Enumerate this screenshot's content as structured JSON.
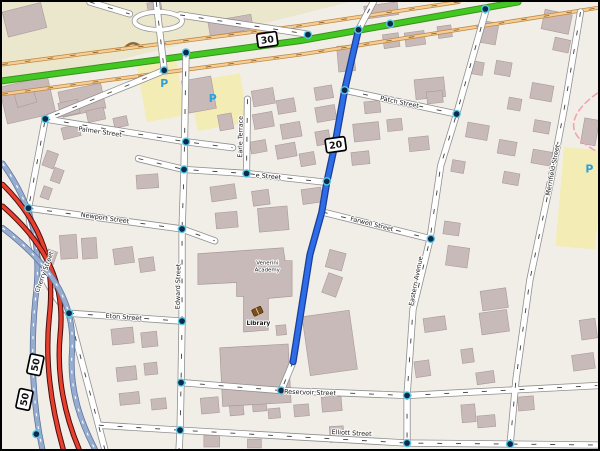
{
  "app": {
    "title": "Map view with highlighted route"
  },
  "colors": {
    "land": "#f1eee8",
    "khaki": "#ebe7cc",
    "parking_fill": "#f3ecb4",
    "building": "#c9baba",
    "building_border": "#a99a9a",
    "street_fill": "#ffffff",
    "street_casing": "#8f8f8f",
    "street_dash": "#3d3d3d",
    "green_road": "#41c922",
    "green_casing": "#3d8f1d",
    "tan_fill": "#f2cf9a",
    "tan_casing": "#c8873a",
    "motorway_fill": "#97adcf",
    "motorway_casing": "#5f74a0",
    "trunk_red": "#e8402e",
    "trunk_casing": "#4a0d0d",
    "route_blue": "#2e6ce8",
    "route_casing": "#173f9b",
    "dot_ring": "#57c8e6",
    "dot_core": "#0c2b4a",
    "boundary_pink": "#f2a3ad",
    "parking_icon": "#2d9fdb",
    "school_label": "#50507c",
    "library_label": "#6b5a10",
    "book_icon": "#7c4f17"
  },
  "map": {
    "width": 600,
    "height": 451,
    "khaki_poly": "0,0 350,0 0,88",
    "parking_areas": [
      [
        140,
        60,
        40,
        58,
        -10
      ],
      [
        192,
        76,
        52,
        50,
        -10
      ],
      [
        562,
        148,
        40,
        100,
        5
      ]
    ],
    "hedge_arc": "M122,48 Q130,37 139,45",
    "buildings": [
      [
        2,
        5,
        40,
        26,
        -14
      ],
      [
        0,
        80,
        50,
        38,
        -13
      ],
      [
        58,
        86,
        44,
        26,
        -12
      ],
      [
        208,
        16,
        44,
        15,
        -10
      ],
      [
        146,
        0,
        14,
        8,
        -10
      ],
      [
        365,
        2,
        34,
        13,
        -8
      ],
      [
        545,
        10,
        28,
        20,
        12
      ],
      [
        556,
        37,
        16,
        13,
        12
      ],
      [
        13,
        90,
        20,
        14,
        -16
      ],
      [
        57,
        100,
        20,
        14,
        -12
      ],
      [
        85,
        108,
        18,
        12,
        -12
      ],
      [
        112,
        116,
        14,
        10,
        -12
      ],
      [
        183,
        77,
        30,
        33,
        -10
      ],
      [
        40,
        153,
        16,
        12,
        -70
      ],
      [
        48,
        170,
        14,
        10,
        -70
      ],
      [
        38,
        188,
        12,
        9,
        -70
      ],
      [
        135,
        174,
        22,
        14,
        -4
      ],
      [
        60,
        125,
        18,
        12,
        -14
      ],
      [
        58,
        235,
        17,
        24,
        -4
      ],
      [
        80,
        238,
        15,
        21,
        -4
      ],
      [
        112,
        248,
        20,
        16,
        -8
      ],
      [
        138,
        258,
        15,
        14,
        -8
      ],
      [
        42,
        252,
        13,
        10,
        -70
      ],
      [
        110,
        329,
        22,
        16,
        -6
      ],
      [
        140,
        333,
        16,
        15,
        -6
      ],
      [
        115,
        368,
        20,
        14,
        -6
      ],
      [
        143,
        364,
        13,
        12,
        -6
      ],
      [
        118,
        394,
        20,
        12,
        -6
      ],
      [
        150,
        400,
        15,
        11,
        -6
      ],
      [
        218,
        113,
        14,
        16,
        -10
      ],
      [
        252,
        88,
        22,
        16,
        -10
      ],
      [
        277,
        98,
        18,
        14,
        -10
      ],
      [
        315,
        85,
        18,
        13,
        -10
      ],
      [
        316,
        105,
        20,
        15,
        -10
      ],
      [
        253,
        112,
        20,
        15,
        -10
      ],
      [
        281,
        122,
        20,
        15,
        -10
      ],
      [
        316,
        130,
        14,
        14,
        -10
      ],
      [
        276,
        143,
        20,
        14,
        -10
      ],
      [
        250,
        140,
        16,
        12,
        -10
      ],
      [
        300,
        152,
        15,
        13,
        -10
      ],
      [
        210,
        185,
        25,
        15,
        -8
      ],
      [
        252,
        190,
        17,
        15,
        -8
      ],
      [
        302,
        188,
        20,
        15,
        -8
      ],
      [
        258,
        207,
        30,
        24,
        -5
      ],
      [
        215,
        212,
        22,
        16,
        -5
      ],
      [
        338,
        44,
        17,
        26,
        -5
      ],
      [
        384,
        32,
        16,
        14,
        -8
      ],
      [
        406,
        30,
        20,
        14,
        -8
      ],
      [
        439,
        24,
        14,
        12,
        -8
      ],
      [
        416,
        77,
        30,
        20,
        -6
      ],
      [
        365,
        100,
        16,
        12,
        -6
      ],
      [
        354,
        122,
        26,
        18,
        -6
      ],
      [
        388,
        118,
        15,
        12,
        -6
      ],
      [
        410,
        136,
        20,
        14,
        -6
      ],
      [
        352,
        151,
        18,
        13,
        -6
      ],
      [
        428,
        90,
        16,
        12,
        -6
      ],
      [
        327,
        252,
        18,
        17,
        -75
      ],
      [
        322,
        278,
        21,
        15,
        -70
      ],
      [
        306,
        314,
        48,
        60,
        -8
      ],
      [
        482,
        20,
        17,
        22,
        10
      ],
      [
        470,
        60,
        15,
        13,
        10
      ],
      [
        497,
        60,
        16,
        14,
        10
      ],
      [
        533,
        83,
        22,
        16,
        10
      ],
      [
        510,
        97,
        13,
        12,
        10
      ],
      [
        536,
        120,
        16,
        12,
        10
      ],
      [
        500,
        140,
        18,
        14,
        10
      ],
      [
        534,
        150,
        20,
        14,
        10
      ],
      [
        505,
        172,
        16,
        12,
        10
      ],
      [
        468,
        123,
        22,
        15,
        10
      ],
      [
        453,
        160,
        13,
        12,
        10
      ],
      [
        448,
        247,
        22,
        20,
        8
      ],
      [
        445,
        222,
        16,
        13,
        8
      ],
      [
        483,
        290,
        26,
        20,
        -8
      ],
      [
        482,
        312,
        28,
        22,
        -8
      ],
      [
        463,
        350,
        12,
        14,
        -8
      ],
      [
        478,
        373,
        18,
        12,
        -8
      ],
      [
        425,
        318,
        22,
        14,
        -8
      ],
      [
        416,
        362,
        15,
        16,
        -8
      ],
      [
        200,
        399,
        18,
        16,
        -5
      ],
      [
        229,
        403,
        14,
        14,
        -5
      ],
      [
        252,
        398,
        14,
        15,
        -5
      ],
      [
        268,
        410,
        12,
        10,
        -5
      ],
      [
        294,
        406,
        15,
        12,
        -5
      ],
      [
        322,
        398,
        20,
        15,
        -5
      ],
      [
        463,
        406,
        14,
        18,
        -5
      ],
      [
        479,
        417,
        18,
        12,
        -5
      ],
      [
        520,
        398,
        16,
        14,
        -5
      ],
      [
        585,
        118,
        15,
        26,
        10
      ],
      [
        583,
        320,
        16,
        20,
        -8
      ],
      [
        575,
        355,
        22,
        16,
        -8
      ],
      [
        203,
        437,
        16,
        12,
        0
      ],
      [
        247,
        441,
        14,
        9,
        0
      ],
      [
        330,
        428,
        14,
        16,
        -3
      ],
      [
        276,
        326,
        10,
        10,
        -5
      ]
    ],
    "academy_polys": [
      "197,254 283,248 285,261 292,261 292,297 268,299 268,331 243,333 243,297 236,297 236,283 197,285",
      "219,349 288,345 291,404 222,408"
    ],
    "tan_roads": [
      "M0,63 L300,24 L460,0",
      "M0,93 L300,53 L600,6"
    ],
    "green_road": "M-4,80 L300,39 L520,0",
    "loop_ellipse": [
      157,
      19,
      24,
      9
    ],
    "streets": [
      {
        "name": "top-vertical-street",
        "d": "M155,0 L163,69"
      },
      {
        "name": "cherry-street-diagonal",
        "d": "M163,69 L43,118 L26,208 C30,260 45,290 67,314 L103,451"
      },
      {
        "name": "edward-street",
        "d": "M185,51 L183,169 L181,229 L181,322 L180,384 L179,432 L178,451"
      },
      {
        "name": "earle-terrace",
        "d": "M247,98 L246,172"
      },
      {
        "name": "e-street",
        "d": "M137,158 L183,169 L246,173 L327,182"
      },
      {
        "name": "palmer-street",
        "d": "M43,118 L185,141 L232,147"
      },
      {
        "name": "newport-street",
        "d": "M26,208 L181,229 L214,241"
      },
      {
        "name": "eton-street",
        "d": "M67,314 L181,322"
      },
      {
        "name": "reservoir-street",
        "d": "M180,384 L281,392 L408,397 L600,387"
      },
      {
        "name": "elliott-street",
        "d": "M97,427 L179,432 L408,445 L512,446 L600,447"
      },
      {
        "name": "patch-street",
        "d": "M345,89 L458,113"
      },
      {
        "name": "farwell-street",
        "d": "M323,212 L432,239"
      },
      {
        "name": "route-street",
        "d": "M359,28 L345,89 L335,145 L327,182 L322,212 L310,255 L293,363 L281,392"
      },
      {
        "name": "eastern-avenue",
        "d": "M488,7 L458,113 L442,165 L431,240 L414,310 L408,397 L408,445"
      },
      {
        "name": "merrifield-street",
        "d": "M583,10 L568,100 L553,180 L532,280 L518,380 L512,446"
      },
      {
        "name": "top-stub-street",
        "d": "M359,28 L374,0"
      },
      {
        "name": "top-loop-street-a",
        "d": "M88,0 L128,12"
      },
      {
        "name": "top-loop-street-b",
        "d": "M179,13 L232,21 L305,32"
      }
    ],
    "motorways": [
      {
        "kind": "blue",
        "d": "M0,163 C30,205 40,245 33,300 C28,352 30,405 40,451"
      },
      {
        "kind": "red",
        "d": "M0,184 C42,226 53,266 47,318 C42,366 50,412 61,451"
      },
      {
        "kind": "red",
        "d": "M0,206 C48,248 63,288 58,336 C54,378 63,418 77,451"
      },
      {
        "kind": "blue",
        "d": "M0,228 C55,270 73,308 70,352 C67,392 79,424 93,451"
      }
    ],
    "blue_route": "M359,28 L345,89 L335,145 L327,182 L322,212 L310,255 L293,363",
    "boundary": "M600,92 C583,104 570,120 579,134 C584,142 594,148 600,151",
    "junction_dots": [
      [
        163,
        69
      ],
      [
        185,
        51
      ],
      [
        43,
        118
      ],
      [
        185,
        141
      ],
      [
        308,
        33
      ],
      [
        359,
        28
      ],
      [
        391,
        22
      ],
      [
        487,
        7
      ],
      [
        345,
        89
      ],
      [
        458,
        113
      ],
      [
        183,
        169
      ],
      [
        246,
        173
      ],
      [
        26,
        208
      ],
      [
        181,
        229
      ],
      [
        327,
        181
      ],
      [
        432,
        239
      ],
      [
        67,
        314
      ],
      [
        181,
        322
      ],
      [
        180,
        384
      ],
      [
        281,
        392
      ],
      [
        408,
        397
      ],
      [
        179,
        432
      ],
      [
        408,
        445
      ],
      [
        512,
        446
      ],
      [
        34,
        436
      ]
    ],
    "street_labels": [
      {
        "t": "Palmer Street",
        "x": 98,
        "y": 133,
        "r": 8
      },
      {
        "t": "e Street",
        "x": 268,
        "y": 178,
        "r": 5
      },
      {
        "t": "Newport Street",
        "x": 103,
        "y": 220,
        "r": 8
      },
      {
        "t": "Eton Street",
        "x": 122,
        "y": 320,
        "r": 4
      },
      {
        "t": "Reservoir Street",
        "x": 310,
        "y": 396,
        "r": 2
      },
      {
        "t": "Elliott Street",
        "x": 352,
        "y": 437,
        "r": 3
      },
      {
        "t": "Patch Street",
        "x": 400,
        "y": 103,
        "r": 12
      },
      {
        "t": "Farwell Street",
        "x": 372,
        "y": 226,
        "r": 14
      },
      {
        "t": "Edward Street",
        "x": 179,
        "y": 287,
        "r": -89
      },
      {
        "t": "Earle Terrace",
        "x": 242,
        "y": 136,
        "r": -89
      },
      {
        "t": "Eastern Avenue",
        "x": 419,
        "y": 282,
        "r": -79
      },
      {
        "t": "Merrifield Street",
        "x": 557,
        "y": 170,
        "r": -79
      },
      {
        "t": "Cherry Street",
        "x": 44,
        "y": 273,
        "r": -70
      }
    ],
    "poi_labels": [
      {
        "t": "Venerini",
        "x": 267,
        "y": 265,
        "r": 0,
        "s": 5.5,
        "c": "#50507c",
        "name": "school-label"
      },
      {
        "t": "Academy",
        "x": 267,
        "y": 272,
        "r": 0,
        "s": 5.5,
        "c": "#50507c",
        "name": "school-label"
      },
      {
        "t": "Library",
        "x": 258,
        "y": 326,
        "r": 0,
        "s": 6,
        "c": "#6b5a10",
        "b": 1,
        "name": "library-label"
      }
    ],
    "parking_icons": [
      {
        "t": "P",
        "x": 163,
        "y": 86
      },
      {
        "t": "P",
        "x": 212,
        "y": 101
      },
      {
        "t": "P",
        "x": 592,
        "y": 172
      }
    ],
    "library_icon": {
      "x": 257,
      "y": 312
    },
    "shields": [
      {
        "t": "30",
        "x": 267,
        "y": 38,
        "r": -8
      },
      {
        "t": "20",
        "x": 336,
        "y": 144,
        "r": -8
      },
      {
        "t": "50",
        "x": 33,
        "y": 366,
        "r": -78
      },
      {
        "t": "50",
        "x": 22,
        "y": 401,
        "r": -78
      }
    ]
  }
}
